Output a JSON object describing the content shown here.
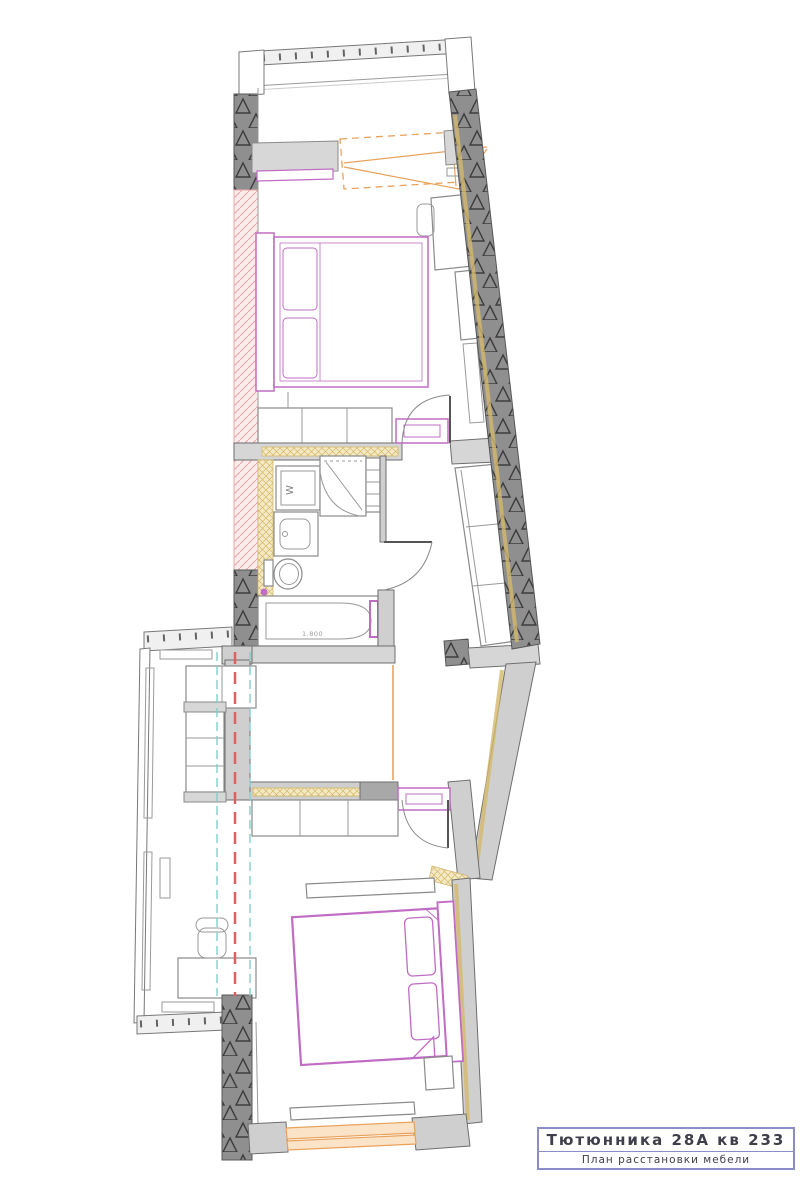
{
  "page": {
    "background": "#ffffff"
  },
  "title_block": {
    "address": "Тютюнника 28А кв 233",
    "subtitle": "План расстановки мебели"
  },
  "labels": {
    "washing_machine": "W",
    "bathtub_length": "1.800"
  },
  "colors": {
    "wall_dark": "#8f8f8f",
    "wall_glyph": "#3d3d3d",
    "wall_gray": "#cfcfcf",
    "wall_band": "#d6d6d6",
    "furniture_line": "#8a8a8a",
    "furniture_fill": "#d7d7d7",
    "magenta": "#c06cc4",
    "orange": "#e8a25c",
    "yellow_fill": "#f5e9c4",
    "yellow_line": "#d3b86a",
    "pink_fill": "#fbecec",
    "pink_line": "#e8a8a8",
    "red_axis": "#e06060",
    "cyan_axis": "#7fd0cc",
    "title_border": "#8c8cc8",
    "title_text": "#3f3f4a"
  }
}
